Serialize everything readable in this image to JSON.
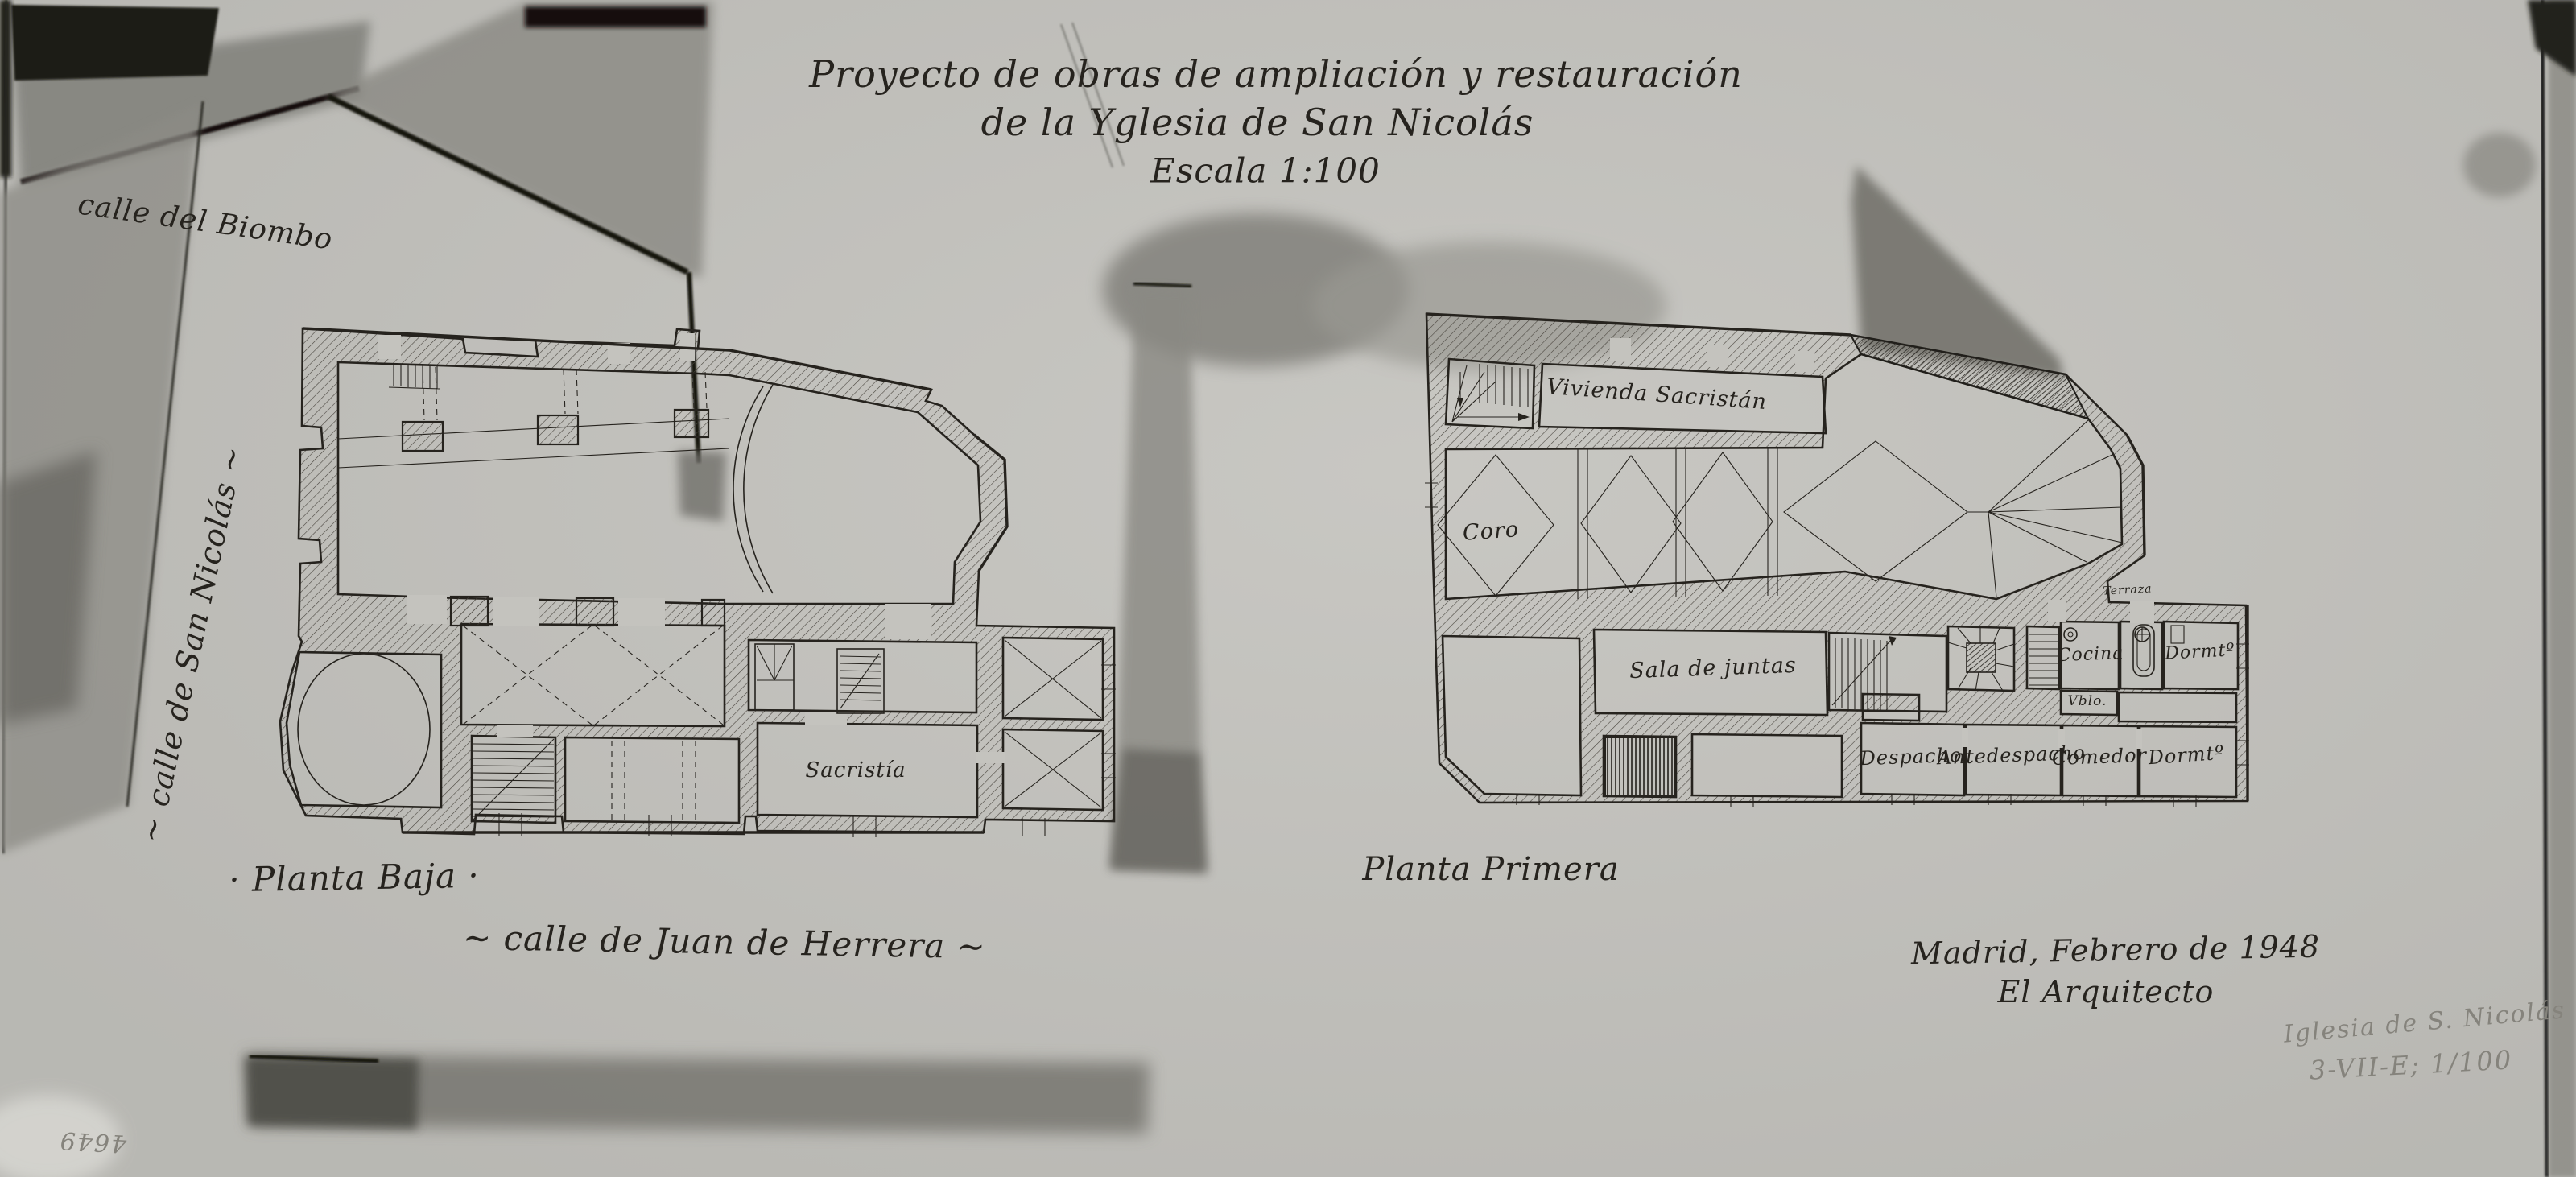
{
  "sheet": {
    "title_line1": "Proyecto de obras de ampliación y restauración",
    "title_line2": "de la Yglesia de San Nicolás",
    "title_line3": "Escala 1:100",
    "signature_line1": "Madrid, Febrero de 1948",
    "signature_line2": "El Arquitecto"
  },
  "streets": {
    "biombo": "calle del Biombo",
    "san_nicolas": "~ calle de San Nicolás ~",
    "juan_de_herrera": "~ calle de Juan de Herrera ~"
  },
  "plans": {
    "planta_baja": {
      "label": "· Planta Baja ·",
      "rooms": {
        "sacristia": "Sacristía"
      }
    },
    "planta_primera": {
      "label": "Planta Primera",
      "rooms": {
        "vivienda_sacristan": "Vivienda Sacristán",
        "coro": "Coro",
        "sala_de_juntas": "Sala de juntas",
        "cocina": "Cocina",
        "dormitorio_1": "Dormtº",
        "vestibulo": "Vblo.",
        "despacho": "Despacho",
        "antedespacho": "Antedespacho",
        "comedor": "Comedor",
        "dormitorio_2": "Dormtº",
        "terraza": "Terraza"
      }
    }
  },
  "annotations": {
    "pencil_line1": "Iglesia de S. Nicolás",
    "pencil_line2": "3-VII-E; 1/100",
    "archive_number": "4649"
  },
  "colors": {
    "paper": "#c4c3be",
    "ink": "#26231e",
    "pencil": "#85837c",
    "smudge": "#7b7a74",
    "shadow": "#151411"
  }
}
